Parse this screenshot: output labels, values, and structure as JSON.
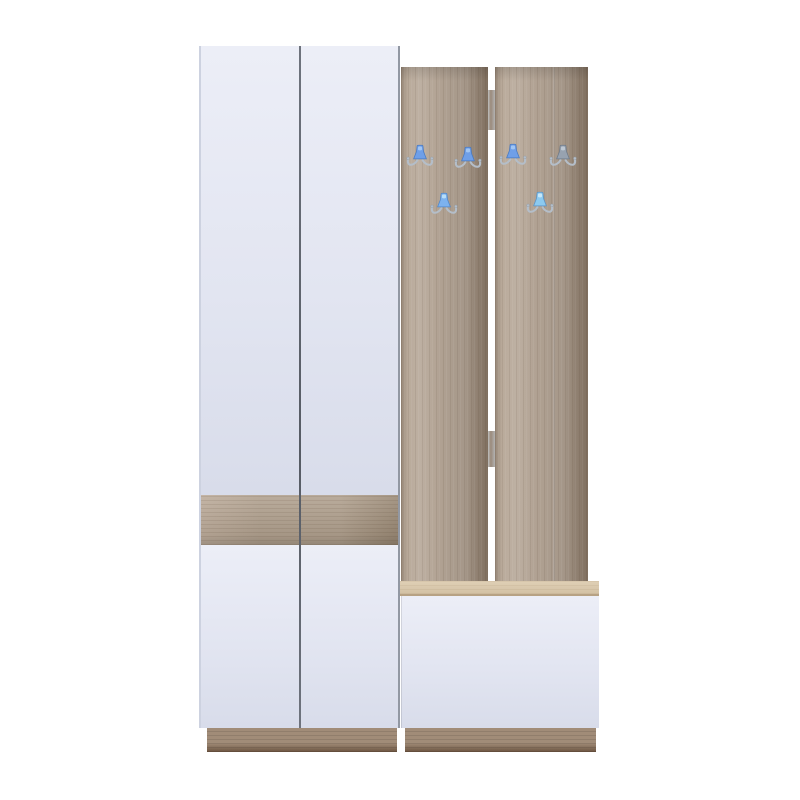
{
  "scene": {
    "description": "Product photo of a hallway entryway furniture set on a plain white background: a tall white two-door wardrobe with a sonoma-oak accent band, two vertical oak coat-hook panels with six double metal hooks with colored caps, and a low white shoe bench with an oak top and oak plinth",
    "item_type": "entryway wardrobe and coat rack set with shoe bench",
    "background_color": "#ffffff",
    "text_visible": "none"
  },
  "parts": {
    "wardrobe": "white two-door wardrobe with oak accent band",
    "upper_doors": "two tall white doors",
    "oak_band": "horizontal sonoma oak accent band",
    "lower_doors": "two short white doors",
    "hook_panel_left": "vertical sonoma oak coat-hook panel",
    "hook_panel_right": "vertical sonoma oak coat-hook panel",
    "bench_top": "sonoma oak bench seat",
    "bench_front": "white flap front of shoe bench",
    "plinth": "sonoma oak base plinth"
  },
  "colors": {
    "background": "#ffffff",
    "door_white_light": "#eceef7",
    "door_white": "#e2e5f1",
    "door_white_dark": "#d8dcea",
    "divider": "#6e737d",
    "oak_band_light": "#bcab9a",
    "oak_band": "#b0a08e",
    "oak_band_dark": "#998874",
    "panel_wood_light": "#bcad9d",
    "panel_wood": "#b0a192",
    "panel_wood_dark": "#9a8a79",
    "batten": "#9a8a7a",
    "bench_top_light": "#e0d0b6",
    "bench_top": "#d3c1a4",
    "bench_top_edge": "#b7a284",
    "plinth": "#a18c78",
    "plinth_dark": "#6c5440",
    "hook_metal": "#b4bec9",
    "hook_metal_dark": "#8f99a4",
    "hook_blue": "#6f9fe8",
    "hook_gray": "#97a2b0",
    "hook_cyan": "#85c6f0"
  },
  "hooks": [
    {
      "name": "coat-hook-1",
      "x": 420,
      "y": 157,
      "cap": "#6f9fe8",
      "cap_light": "#aacdf6",
      "cap_edge": "#4a7ac0"
    },
    {
      "name": "coat-hook-2",
      "x": 468,
      "y": 159,
      "cap": "#6f9fe8",
      "cap_light": "#aacdf6",
      "cap_edge": "#4a7ac0"
    },
    {
      "name": "coat-hook-3",
      "x": 513,
      "y": 156,
      "cap": "#6f9fe8",
      "cap_light": "#aacdf6",
      "cap_edge": "#4a7ac0"
    },
    {
      "name": "coat-hook-4",
      "x": 563,
      "y": 157,
      "cap": "#97a2b0",
      "cap_light": "#c6cfd9",
      "cap_edge": "#6f7a88"
    },
    {
      "name": "coat-hook-5",
      "x": 444,
      "y": 205,
      "cap": "#7db2ee",
      "cap_light": "#c2e5fa",
      "cap_edge": "#5187c8"
    },
    {
      "name": "coat-hook-6",
      "x": 540,
      "y": 204,
      "cap": "#8ccaf0",
      "cap_light": "#d2edfc",
      "cap_edge": "#5b93c6"
    }
  ]
}
